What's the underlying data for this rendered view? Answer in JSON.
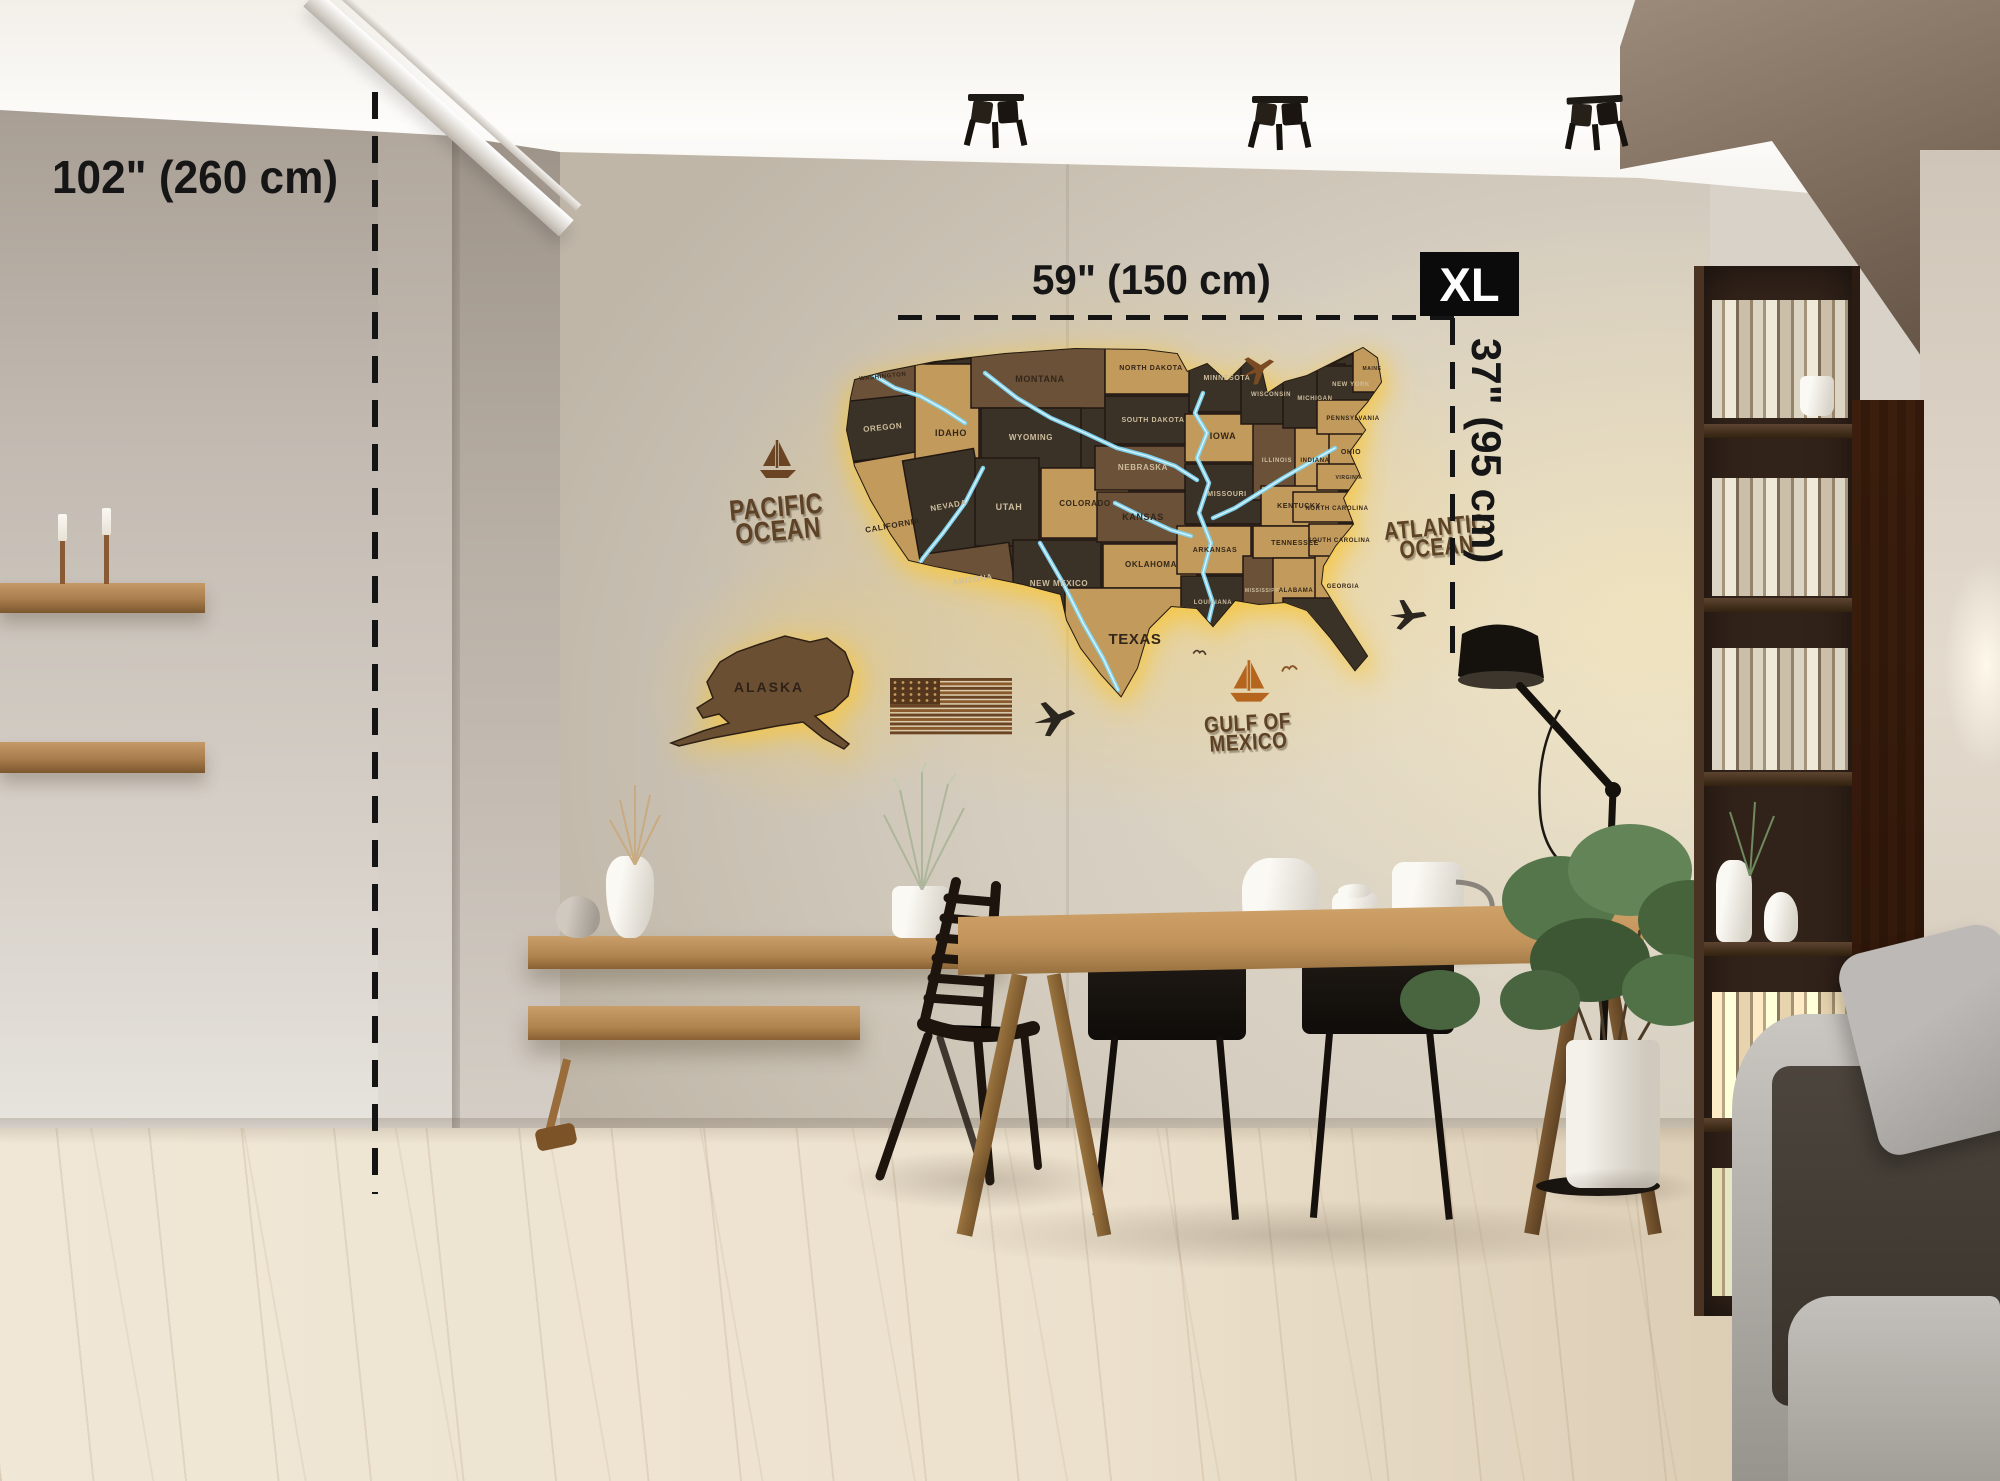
{
  "scene": {
    "description": "Living room with 3D wooden LED-backlit US map on concrete wall, dining table, shelves, bookcase, floor lamp and sofa",
    "product": "Wooden US map wall decor with LED backlight"
  },
  "annotations": {
    "wall_height_label": "102\" (260 cm)",
    "map_width_label": "59\" (150 cm)",
    "map_height_label": "37\" (95 cm)",
    "size_badge": "XL",
    "badge_bg": "#0b0b0b",
    "badge_fg": "#ffffff",
    "line_color": "#141414"
  },
  "map": {
    "alaska_label": "ALASKA",
    "ocean": {
      "pacific1": "PACIFIC",
      "pacific2": "OCEAN",
      "atlantic1": "ATLANTIC",
      "atlantic2": "OCEAN",
      "gulf1": "GULF OF",
      "gulf2": "MEXICO"
    },
    "colors": {
      "oak": "#c29a5b",
      "walnut": "#6a5138",
      "espresso": "#3b3227",
      "river": "#7fd6f2",
      "river_hi": "#d9f4ff",
      "glow": "#f7c63e",
      "engrave_dark": "#33261a",
      "engrave_light": "#cdbd9d",
      "seam": "#221812"
    },
    "outline": "M 40 42 L 70 34 L 120 24 L 190 16 L 260 11 L 330 12 L 362 16 L 372 34 L 392 26 L 412 44 L 432 24 L 446 30 L 452 56 L 470 44 L 492 38 L 520 24 L 548 10 L 562 20 L 566 44 L 552 64 L 540 78 L 550 92 L 534 114 L 544 136 L 528 160 L 538 186 L 520 208 L 508 228 L 506 246 L 530 284 L 552 318 L 540 332 L 516 300 L 492 272 L 470 264 L 444 266 L 420 262 L 398 288 L 382 270 L 356 268 L 334 290 L 322 330 L 306 358 L 286 336 L 266 310 L 252 282 L 246 256 L 208 246 L 160 236 L 120 228 L 94 222 L 76 196 L 56 162 L 40 128 L 32 92 L 36 60 Z",
    "alaska_outline": "M 95 18 L 120 10 L 145 16 L 162 12 L 180 26 L 188 46 L 183 70 L 168 84 L 150 90 L 166 104 L 184 118 L 179 123 L 158 112 L 138 96 L 112 100 L 80 106 L 48 112 L 14 120 L 6 117 L 38 105 L 64 97 L 54 88 L 38 92 L 32 82 L 48 72 L 42 56 L 55 36 L 72 26 Z",
    "states": [
      {
        "name": "WASHINGTON",
        "tone": "walnut",
        "r": [
          26,
          10,
          86,
          50
        ],
        "l": [
          68,
          40
        ],
        "fs": 6,
        "lt": "d",
        "rot": -6
      },
      {
        "name": "OREGON",
        "tone": "espresso",
        "r": [
          20,
          60,
          92,
          60
        ],
        "l": [
          68,
          92
        ],
        "fs": 8,
        "lt": "l",
        "rot": -6
      },
      {
        "name": "CALIFORNIA",
        "tone": "oak",
        "r": [
          28,
          120,
          88,
          140
        ],
        "l": [
          78,
          190
        ],
        "fs": 8,
        "lt": "d",
        "rot": -10
      },
      {
        "name": "IDAHO",
        "tone": "oak",
        "r": [
          100,
          26,
          64,
          98
        ],
        "l": [
          136,
          98
        ],
        "fs": 9,
        "lt": "d",
        "rot": 0
      },
      {
        "name": "NEVADA",
        "tone": "espresso",
        "r": [
          96,
          116,
          72,
          104
        ],
        "l": [
          134,
          170
        ],
        "fs": 8,
        "lt": "l",
        "rot": -10
      },
      {
        "name": "MONTANA",
        "tone": "walnut",
        "r": [
          156,
          6,
          134,
          64
        ],
        "l": [
          225,
          44
        ],
        "fs": 9,
        "lt": "d",
        "rot": 0
      },
      {
        "name": "WYOMING",
        "tone": "espresso",
        "r": [
          166,
          70,
          100,
          62
        ],
        "l": [
          216,
          102
        ],
        "fs": 8,
        "lt": "l",
        "rot": 0
      },
      {
        "name": "UTAH",
        "tone": "espresso",
        "r": [
          160,
          120,
          64,
          88
        ],
        "l": [
          194,
          172
        ],
        "fs": 9,
        "lt": "l",
        "rot": 0
      },
      {
        "name": "ARIZONA",
        "tone": "walnut",
        "r": [
          112,
          210,
          88,
          84
        ],
        "l": [
          158,
          244
        ],
        "fs": 8,
        "lt": "l",
        "rot": -8
      },
      {
        "name": "COLORADO",
        "tone": "oak",
        "r": [
          226,
          130,
          88,
          70
        ],
        "l": [
          270,
          168
        ],
        "fs": 8,
        "lt": "d",
        "rot": 0
      },
      {
        "name": "NEW MEXICO",
        "tone": "espresso",
        "r": [
          198,
          202,
          88,
          94
        ],
        "l": [
          244,
          248
        ],
        "fs": 8,
        "lt": "l",
        "rot": 0
      },
      {
        "name": "NORTH DAKOTA",
        "tone": "oak",
        "r": [
          290,
          8,
          88,
          48
        ],
        "l": [
          336,
          32
        ],
        "fs": 7,
        "lt": "d",
        "rot": 0
      },
      {
        "name": "SOUTH DAKOTA",
        "tone": "espresso",
        "r": [
          290,
          58,
          92,
          48
        ],
        "l": [
          338,
          84
        ],
        "fs": 7,
        "lt": "l",
        "rot": 0
      },
      {
        "name": "NEBRASKA",
        "tone": "walnut",
        "r": [
          280,
          108,
          92,
          44
        ],
        "l": [
          328,
          132
        ],
        "fs": 8,
        "lt": "l",
        "rot": 0
      },
      {
        "name": "KANSAS",
        "tone": "walnut",
        "r": [
          282,
          154,
          90,
          50
        ],
        "l": [
          328,
          182
        ],
        "fs": 9,
        "lt": "d",
        "rot": 0
      },
      {
        "name": "OKLAHOMA",
        "tone": "oak",
        "r": [
          288,
          206,
          94,
          44
        ],
        "l": [
          336,
          229
        ],
        "fs": 8,
        "lt": "d",
        "rot": 0
      },
      {
        "name": "TEXAS",
        "tone": "oak",
        "r": [
          250,
          250,
          132,
          112
        ],
        "l": [
          320,
          306
        ],
        "fs": 15,
        "lt": "d",
        "rot": 0
      },
      {
        "name": "MINNESOTA",
        "tone": "espresso",
        "r": [
          374,
          6,
          72,
          68
        ],
        "l": [
          412,
          42
        ],
        "fs": 7,
        "lt": "l",
        "rot": 0
      },
      {
        "name": "IOWA",
        "tone": "oak",
        "r": [
          370,
          76,
          74,
          48
        ],
        "l": [
          408,
          101
        ],
        "fs": 9,
        "lt": "d",
        "rot": 0
      },
      {
        "name": "MISSOURI",
        "tone": "espresso",
        "r": [
          370,
          126,
          80,
          60
        ],
        "l": [
          412,
          158
        ],
        "fs": 7,
        "lt": "l",
        "rot": 0
      },
      {
        "name": "ARKANSAS",
        "tone": "oak",
        "r": [
          362,
          188,
          74,
          48
        ],
        "l": [
          400,
          214
        ],
        "fs": 7,
        "lt": "d",
        "rot": 0
      },
      {
        "name": "LOUISIANA",
        "tone": "espresso",
        "r": [
          366,
          238,
          66,
          56
        ],
        "l": [
          398,
          266
        ],
        "fs": 6,
        "lt": "l",
        "rot": 0
      },
      {
        "name": "MISSISSIPPI",
        "tone": "walnut",
        "r": [
          428,
          218,
          42,
          72
        ],
        "l": [
          448,
          254
        ],
        "fs": 5,
        "lt": "l",
        "rot": 0
      },
      {
        "name": "WISCONSIN",
        "tone": "espresso",
        "r": [
          426,
          20,
          58,
          66
        ],
        "l": [
          456,
          58
        ],
        "fs": 6,
        "lt": "l",
        "rot": 0
      },
      {
        "name": "ILLINOIS",
        "tone": "walnut",
        "r": [
          438,
          86,
          48,
          76
        ],
        "l": [
          462,
          124
        ],
        "fs": 6,
        "lt": "l",
        "rot": 0
      },
      {
        "name": "MICHIGAN",
        "tone": "espresso",
        "r": [
          468,
          26,
          62,
          64
        ],
        "l": [
          500,
          62
        ],
        "fs": 6,
        "lt": "l",
        "rot": 0
      },
      {
        "name": "INDIANA",
        "tone": "oak",
        "r": [
          480,
          90,
          40,
          62
        ],
        "l": [
          500,
          124
        ],
        "fs": 6,
        "lt": "d",
        "rot": 0
      },
      {
        "name": "OHIO",
        "tone": "oak",
        "r": [
          514,
          86,
          44,
          56
        ],
        "l": [
          536,
          116
        ],
        "fs": 7,
        "lt": "d",
        "rot": 0
      },
      {
        "name": "KENTUCKY",
        "tone": "oak",
        "r": [
          446,
          148,
          78,
          40
        ],
        "l": [
          484,
          170
        ],
        "fs": 7,
        "lt": "d",
        "rot": 0
      },
      {
        "name": "TENNESSEE",
        "tone": "oak",
        "r": [
          438,
          188,
          88,
          32
        ],
        "l": [
          480,
          207
        ],
        "fs": 7,
        "lt": "d",
        "rot": 0
      },
      {
        "name": "ALABAMA",
        "tone": "oak",
        "r": [
          458,
          220,
          46,
          62
        ],
        "l": [
          481,
          254
        ],
        "fs": 6,
        "lt": "d",
        "rot": 0
      },
      {
        "name": "GEORGIA",
        "tone": "oak",
        "r": [
          500,
          216,
          56,
          62
        ],
        "l": [
          528,
          250
        ],
        "fs": 6,
        "lt": "d",
        "rot": 0
      },
      {
        "name": "FLORIDA",
        "tone": "espresso",
        "r": [
          468,
          260,
          92,
          78
        ],
        "l": [
          510,
          292
        ],
        "fs": 0,
        "lt": "d",
        "rot": 0
      },
      {
        "name": "PENNSYLVANIA",
        "tone": "oak",
        "r": [
          502,
          60,
          72,
          36
        ],
        "l": [
          538,
          82
        ],
        "fs": 6,
        "lt": "d",
        "rot": 0
      },
      {
        "name": "NEW YORK",
        "tone": "espresso",
        "r": [
          502,
          28,
          68,
          34
        ],
        "l": [
          536,
          48
        ],
        "fs": 6,
        "lt": "l",
        "rot": 0
      },
      {
        "name": "MAINE",
        "tone": "oak",
        "r": [
          538,
          6,
          38,
          48
        ],
        "l": [
          557,
          32
        ],
        "fs": 5,
        "lt": "d",
        "rot": 0
      },
      {
        "name": "VIRGINIA",
        "tone": "oak",
        "r": [
          502,
          126,
          66,
          26
        ],
        "l": [
          534,
          141
        ],
        "fs": 5,
        "lt": "d",
        "rot": 0
      },
      {
        "name": "NORTH CAROLINA",
        "tone": "oak",
        "r": [
          478,
          154,
          90,
          30
        ],
        "l": [
          522,
          172
        ],
        "fs": 6,
        "lt": "d",
        "rot": 0
      },
      {
        "name": "SOUTH CAROLINA",
        "tone": "oak",
        "r": [
          494,
          186,
          64,
          32
        ],
        "l": [
          524,
          204
        ],
        "fs": 6,
        "lt": "d",
        "rot": 0
      }
    ],
    "rivers": [
      [
        [
          388,
          55
        ],
        [
          380,
          75
        ],
        [
          392,
          95
        ],
        [
          382,
          120
        ],
        [
          394,
          145
        ],
        [
          384,
          175
        ],
        [
          396,
          205
        ],
        [
          388,
          235
        ],
        [
          398,
          265
        ],
        [
          392,
          290
        ]
      ],
      [
        [
          170,
          35
        ],
        [
          202,
          60
        ],
        [
          236,
          80
        ],
        [
          270,
          95
        ],
        [
          302,
          110
        ],
        [
          332,
          118
        ],
        [
          360,
          128
        ],
        [
          382,
          142
        ]
      ],
      [
        [
          520,
          110
        ],
        [
          494,
          125
        ],
        [
          468,
          140
        ],
        [
          444,
          155
        ],
        [
          420,
          170
        ],
        [
          398,
          180
        ]
      ],
      [
        [
          168,
          130
        ],
        [
          150,
          165
        ],
        [
          128,
          195
        ],
        [
          108,
          220
        ],
        [
          96,
          240
        ]
      ],
      [
        [
          225,
          205
        ],
        [
          248,
          245
        ],
        [
          268,
          285
        ],
        [
          288,
          320
        ],
        [
          303,
          352
        ]
      ],
      [
        [
          55,
          35
        ],
        [
          80,
          50
        ],
        [
          105,
          58
        ],
        [
          130,
          72
        ],
        [
          150,
          85
        ]
      ],
      [
        [
          300,
          165
        ],
        [
          330,
          180
        ],
        [
          356,
          192
        ],
        [
          376,
          198
        ]
      ]
    ],
    "decor": [
      {
        "kind": "plane",
        "x": 1240,
        "y": 352,
        "w": 38,
        "rot": -18,
        "color": "#7a4a22"
      },
      {
        "kind": "plane",
        "x": 1388,
        "y": 598,
        "w": 40,
        "rot": 8,
        "color": "#2b251f"
      },
      {
        "kind": "plane",
        "x": 1032,
        "y": 698,
        "w": 46,
        "rot": -6,
        "color": "#2b251f"
      },
      {
        "kind": "sailboat",
        "x": 756,
        "y": 438,
        "w": 44,
        "rot": 0,
        "color": "#6b4423"
      },
      {
        "kind": "sailboat",
        "x": 1226,
        "y": 658,
        "w": 48,
        "rot": 0,
        "color": "#b5651d"
      },
      {
        "kind": "bird",
        "x": 1282,
        "y": 662,
        "w": 26,
        "rot": -8,
        "color": "#8a5a2b"
      },
      {
        "kind": "bird",
        "x": 1192,
        "y": 648,
        "w": 22,
        "rot": 6,
        "color": "#4a3828"
      }
    ]
  }
}
